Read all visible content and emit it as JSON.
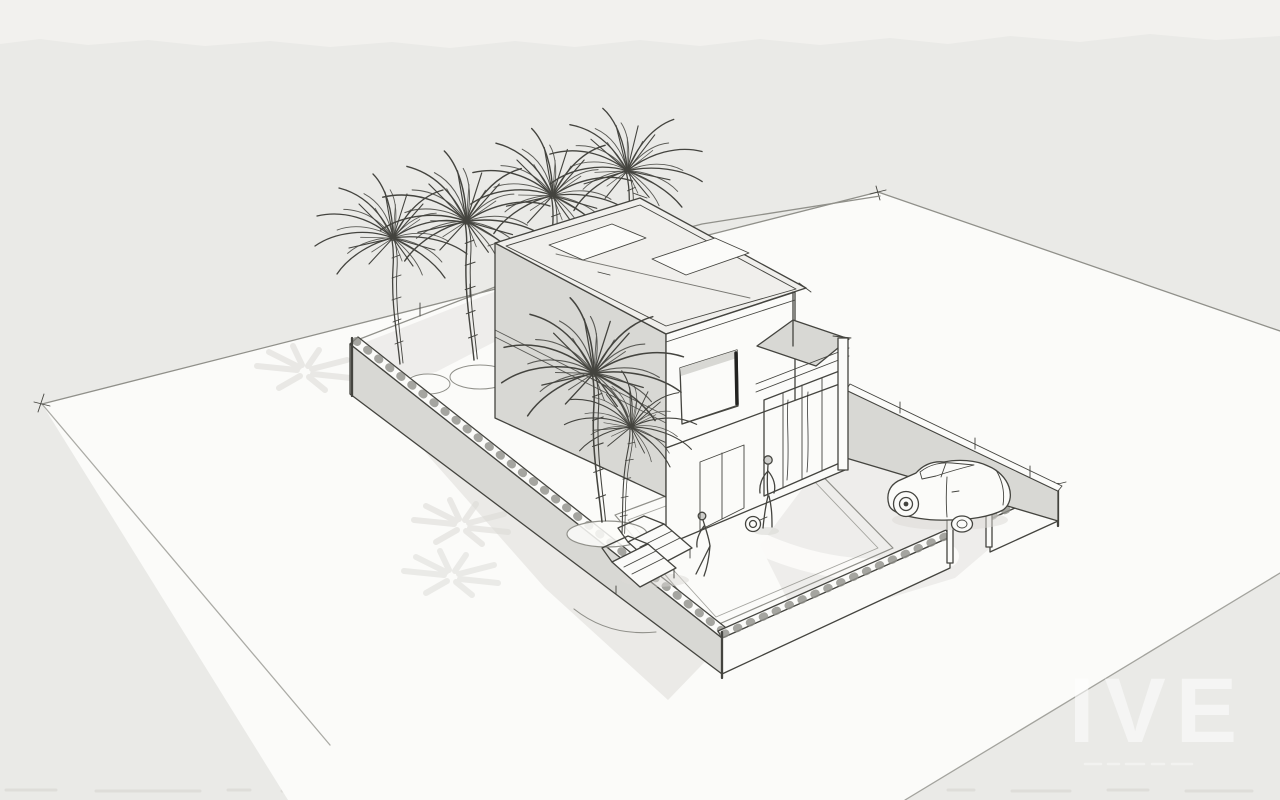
{
  "scene": {
    "type": "architectural-concept-sketch",
    "description": "Hand-drawn perspective sketch of a modern two-storey flat-roof villa on a walled corner plot with palm trees, a roof terrace, sun loungers, two figures and a small parked car",
    "medium": "pencil and ink line work with grey watercolour washes on paper"
  },
  "watermark": {
    "text": "IVE"
  },
  "palette": {
    "paper": "#eaeae7",
    "paper-light": "#f2f1ee",
    "ground": "#fbfbf9",
    "roof": "#f0efec",
    "wall-shade": "#d8d8d4",
    "shadow": "#dbdad6",
    "line": "#44443f",
    "line-soft": "#90908a",
    "line-dark": "#222220"
  },
  "inventory": {
    "house_storeys": 2,
    "roof_type": "flat roof with two skylight panels and roof terrace",
    "palm_trees_background": 4,
    "palm_trees_foreground": 2,
    "palm_shadow_patches": 3,
    "boundary_walls": 3,
    "gate_posts": 2,
    "gate_swing_arc": 1,
    "picture_window": 1,
    "glass_sliding_doors": 1,
    "planter_circles": 3,
    "sun_loungers": 2,
    "figures": 2,
    "hose_reel": 1,
    "car": 1
  }
}
